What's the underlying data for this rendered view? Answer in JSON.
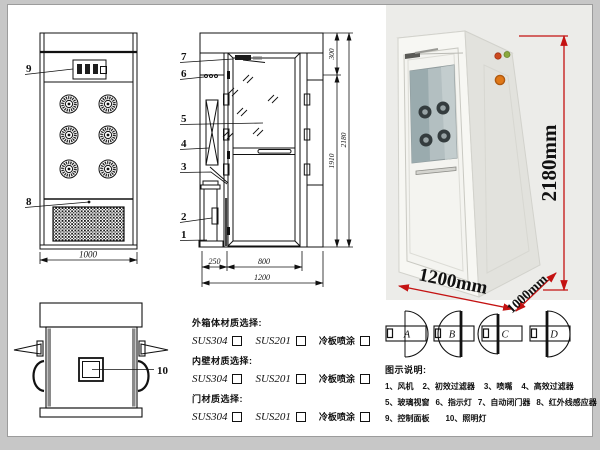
{
  "drawing": {
    "front_view": {
      "callout_control_panel": "9",
      "callout_grille": "8",
      "dim_width": "1000"
    },
    "side_view": {
      "callouts": [
        "7",
        "6",
        "5",
        "4",
        "3",
        "2",
        "1"
      ],
      "dim_top_section": "300",
      "dim_door_height": "1910",
      "dim_total_height": "2180",
      "dim_side_depth": "250",
      "dim_door_width": "800",
      "dim_total_depth": "1200"
    },
    "top_view": {
      "callout_light": "10"
    }
  },
  "photo": {
    "dim_height": "2180mm",
    "dim_width": "1200mm",
    "dim_depth": "1000mm",
    "dim_color": "#c41212"
  },
  "materials": {
    "groups": [
      {
        "label": "外箱体材质选择:",
        "options": [
          "SUS304",
          "SUS201",
          "冷板喷涂"
        ]
      },
      {
        "label": "内壁材质选择:",
        "options": [
          "SUS304",
          "SUS201",
          "冷板喷涂"
        ]
      },
      {
        "label": "门材质选择:",
        "options": [
          "SUS304",
          "SUS201",
          "冷板喷涂"
        ]
      }
    ]
  },
  "door_options": {
    "labels": [
      "A",
      "B",
      "C",
      "D"
    ]
  },
  "legend": {
    "title": "图示说明:",
    "items": [
      "1、风机",
      "2、初效过滤器",
      "3、喷嘴",
      "4、高效过滤器",
      "5、玻璃视窗",
      "6、指示灯",
      "7、自动闭门器",
      "8、红外线感应器",
      "9、控制面板",
      "10、照明灯"
    ]
  }
}
